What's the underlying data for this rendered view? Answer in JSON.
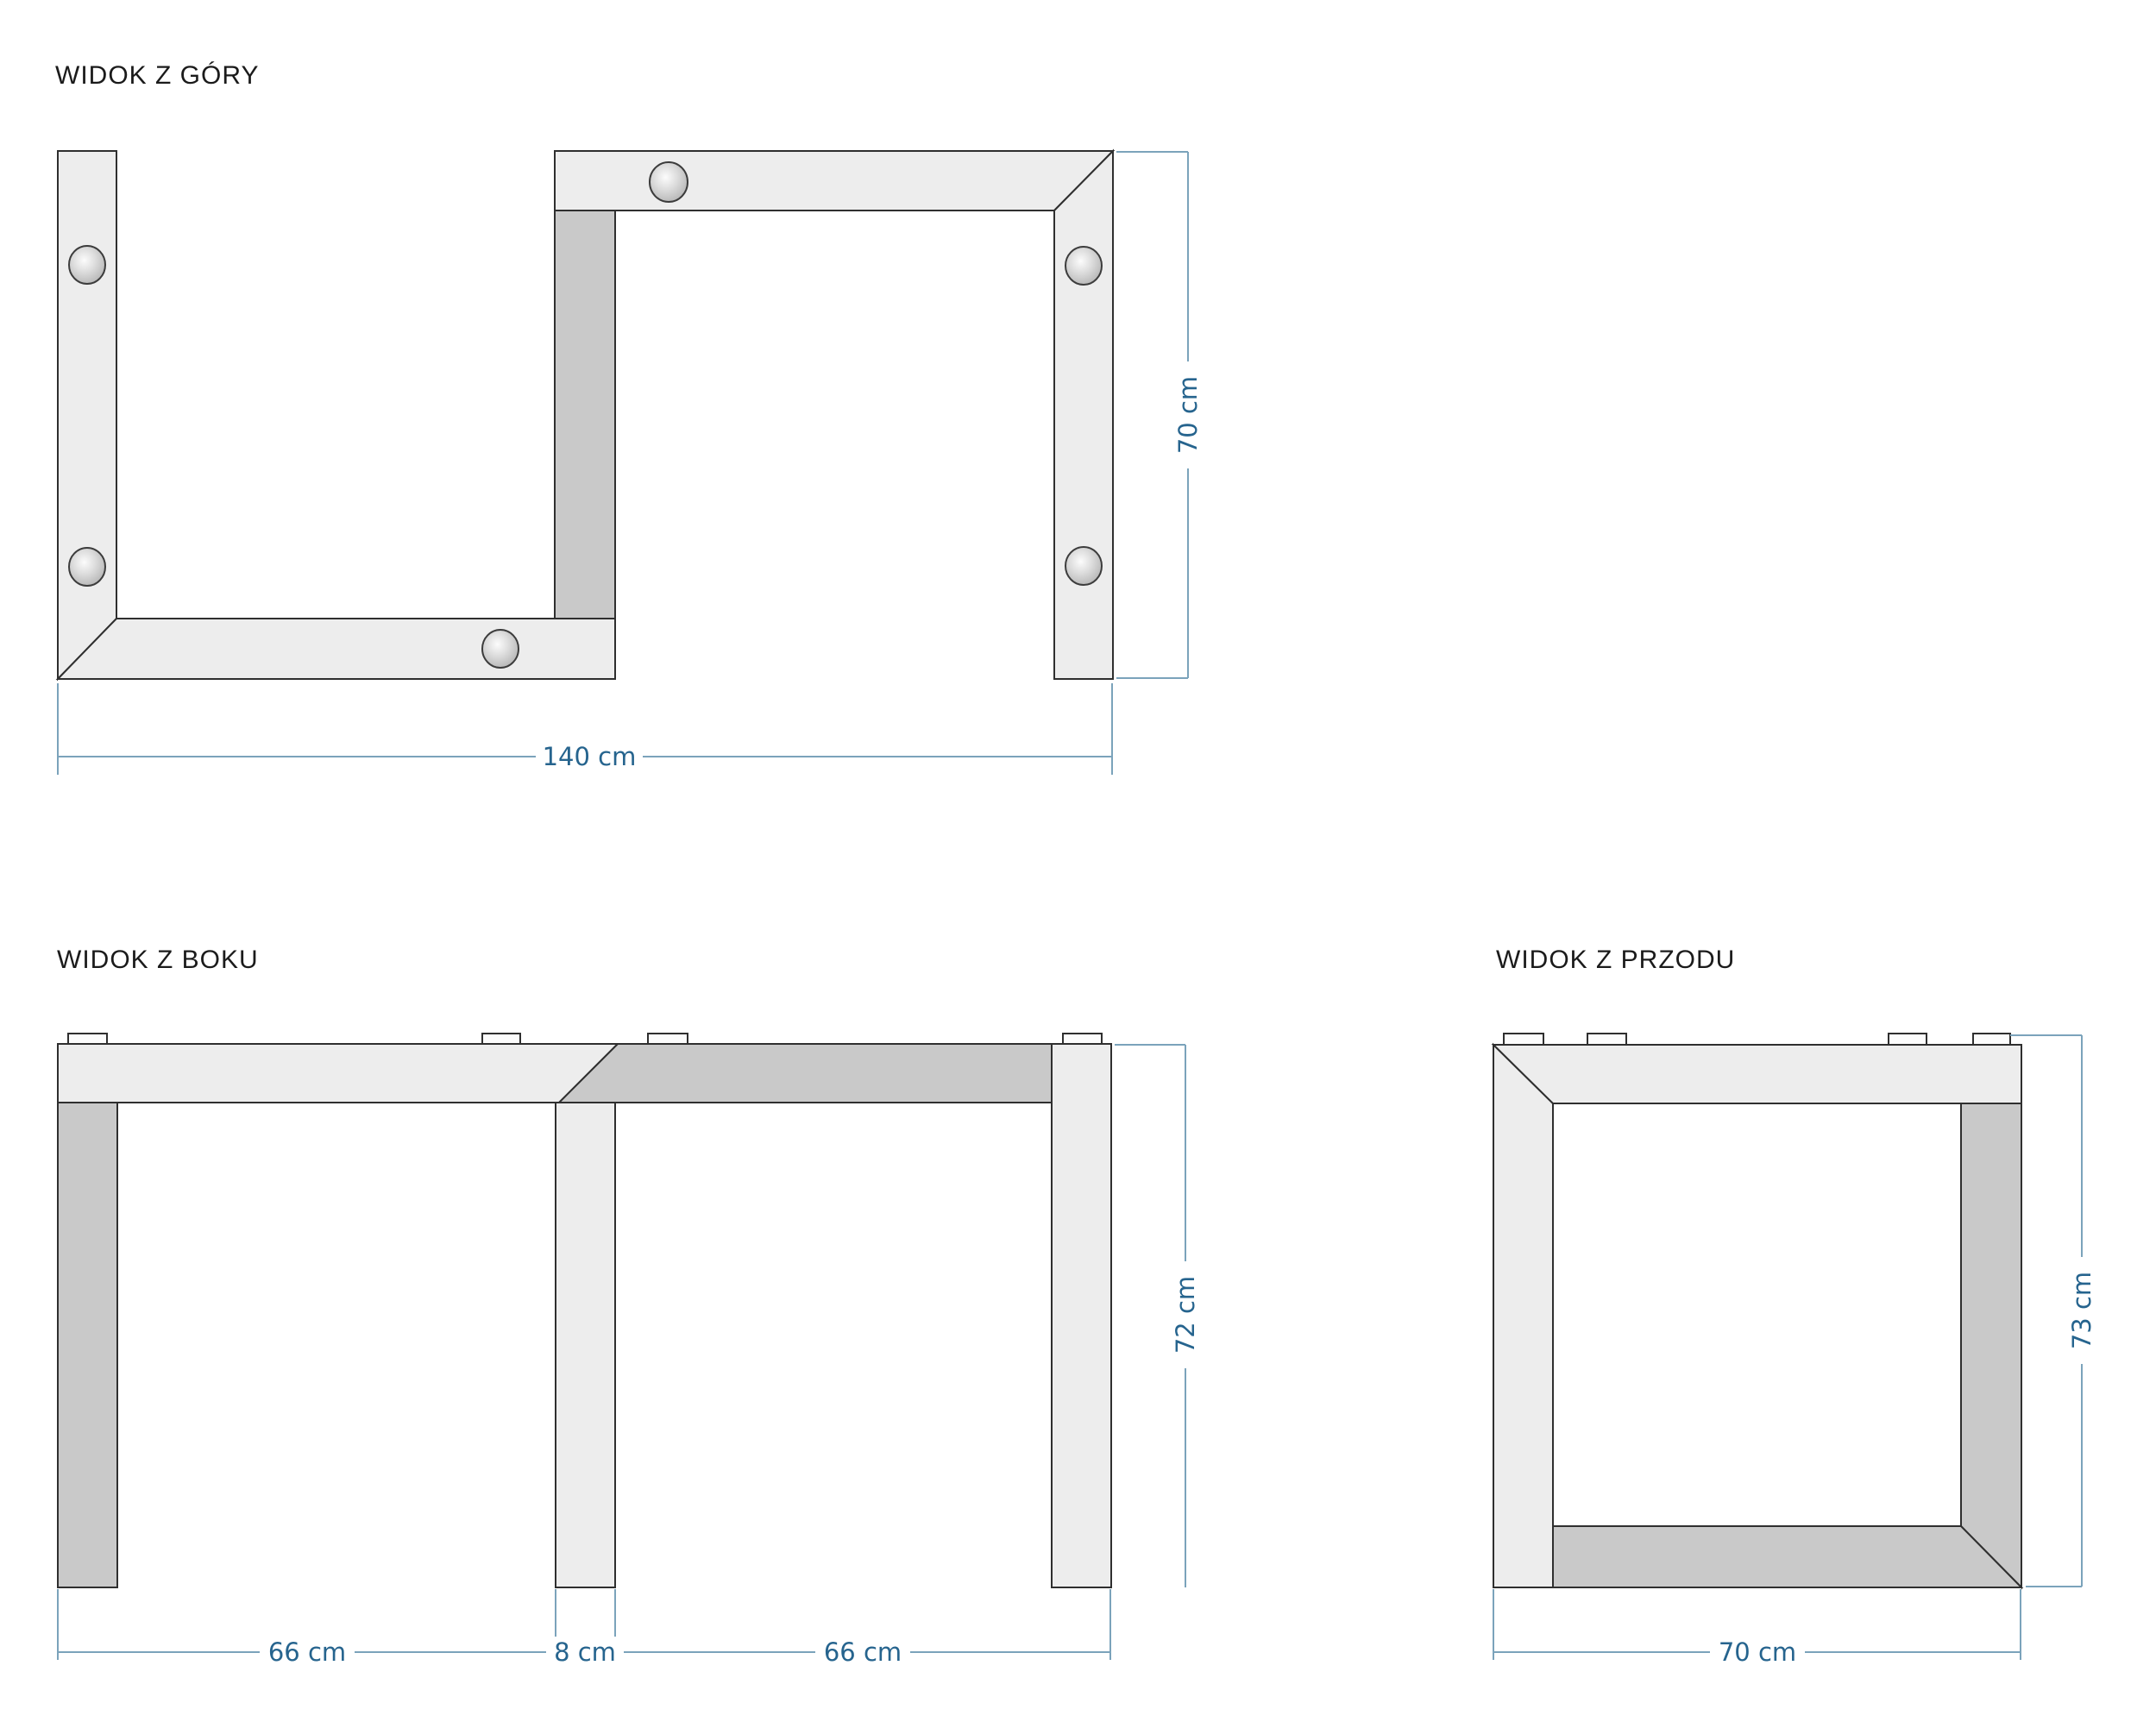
{
  "colors": {
    "bg": "#ffffff",
    "part_light": "#ededed",
    "part_dark": "#c9c9c9",
    "outline": "#2f2f2f",
    "dim_line": "#7ba3bb",
    "dim_text": "#26648e",
    "title_text": "#1b1b1b"
  },
  "icons": {
    "screw": "round screw head with radial highlight"
  },
  "views": {
    "top": {
      "title": "WIDOK Z GÓRY",
      "dims": {
        "width": "140 cm",
        "depth": "70 cm"
      }
    },
    "side": {
      "title": "WIDOK Z BOKU",
      "dims": {
        "left_span": "66 cm",
        "leg": "8 cm",
        "right_span": "66 cm",
        "height": "72 cm"
      }
    },
    "front": {
      "title": "WIDOK Z PRZODU",
      "dims": {
        "width": "70 cm",
        "height": "73 cm"
      }
    }
  }
}
